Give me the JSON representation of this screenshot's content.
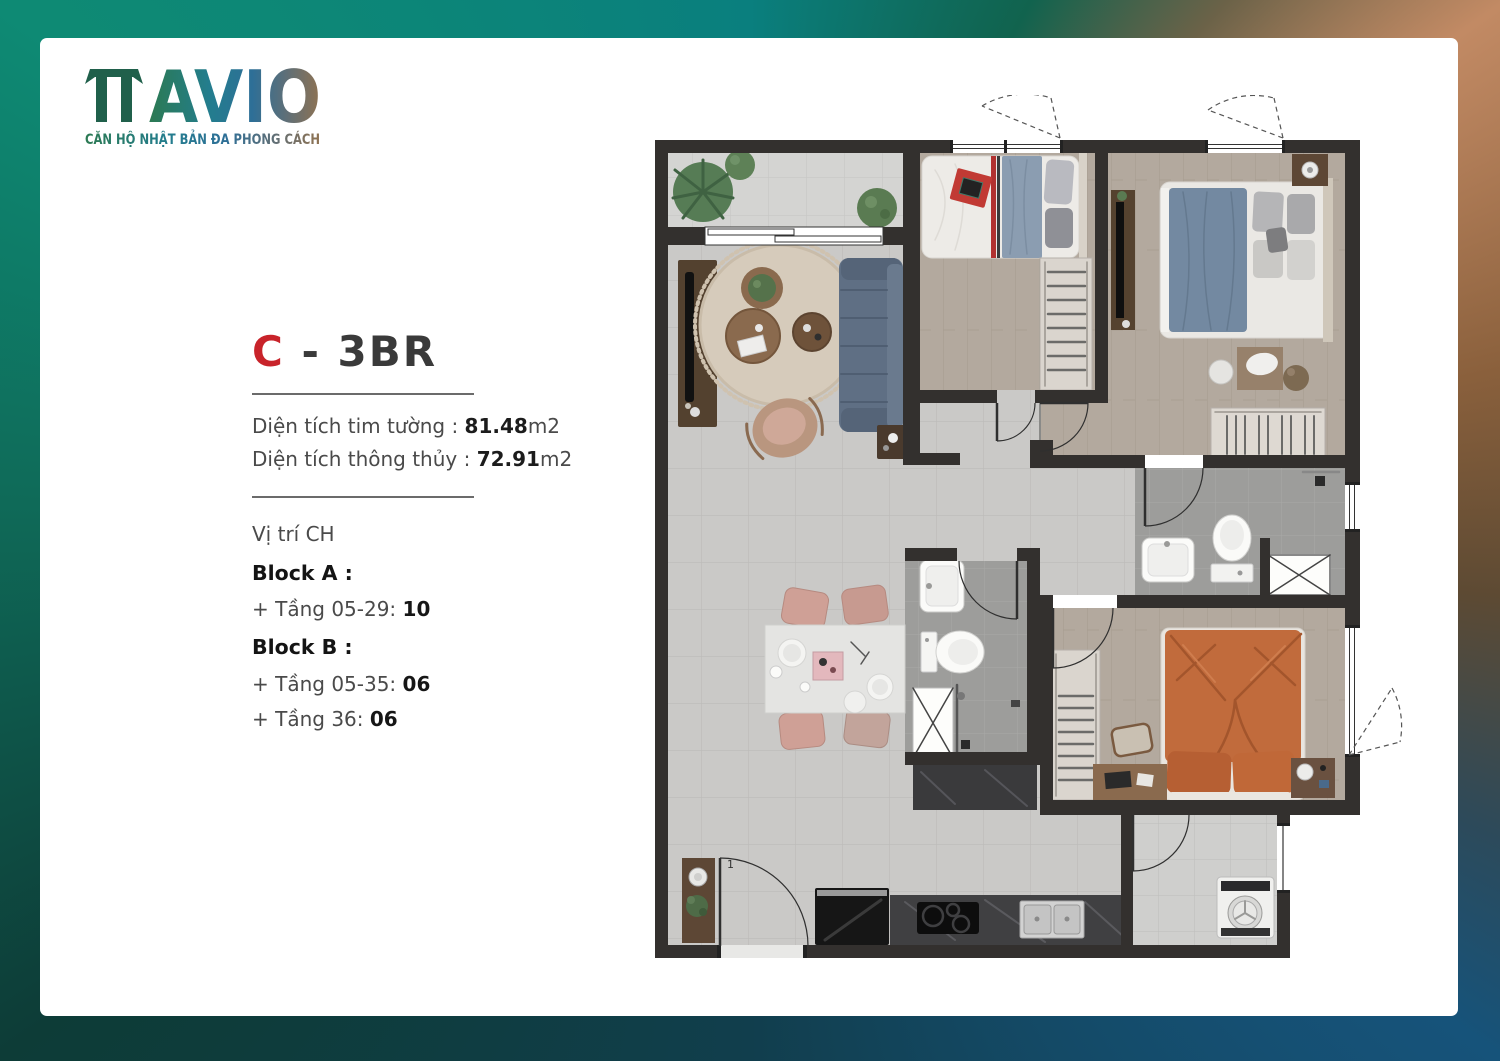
{
  "brand": {
    "name": "AVIO",
    "tagline": "CĂN HỘ NHẬT BẢN ĐA PHONG CÁCH"
  },
  "unit": {
    "letter": "C",
    "dash": "-",
    "type": "3BR"
  },
  "areas": {
    "wall_label": "Diện tích tim tường :",
    "wall_value": "81.48",
    "wall_unit": "m2",
    "clear_label": "Diện tích thông thủy :",
    "clear_value": "72.91",
    "clear_unit": "m2"
  },
  "location": {
    "heading": "Vị trí CH",
    "blocks": [
      {
        "label": "Block A :",
        "lines": [
          {
            "label": "+ Tầng 05-29:",
            "value": "10"
          }
        ]
      },
      {
        "label": "Block B :",
        "lines": [
          {
            "label": "+ Tầng 05-35:",
            "value": "06"
          },
          {
            "label": "+ Tầng 36:",
            "value": "06"
          }
        ]
      }
    ]
  },
  "floorplan": {
    "entry_door_mark": "1",
    "colors": {
      "wall": "#33302e",
      "floor_tile": "#cac9c7",
      "balcony_tile": "#d4d4d2",
      "wood_floor": "#b3a99e",
      "bath_tile": "#9d9d9b",
      "sofa_blue": "#5f6f84",
      "bed_blue": "#7389a1",
      "bed_orange": "#c16b3c",
      "rug_beige": "#d6cbbb",
      "counter_dark": "#404042",
      "chair_pink": "#cfa096",
      "accent_red": "#c13a34"
    }
  },
  "page_colors": {
    "border_green": "#0e8a74",
    "border_copper": "#c28a64",
    "border_dark_teal": "#0d3c37",
    "border_blue": "#16537a",
    "title_red": "#c8232a"
  }
}
